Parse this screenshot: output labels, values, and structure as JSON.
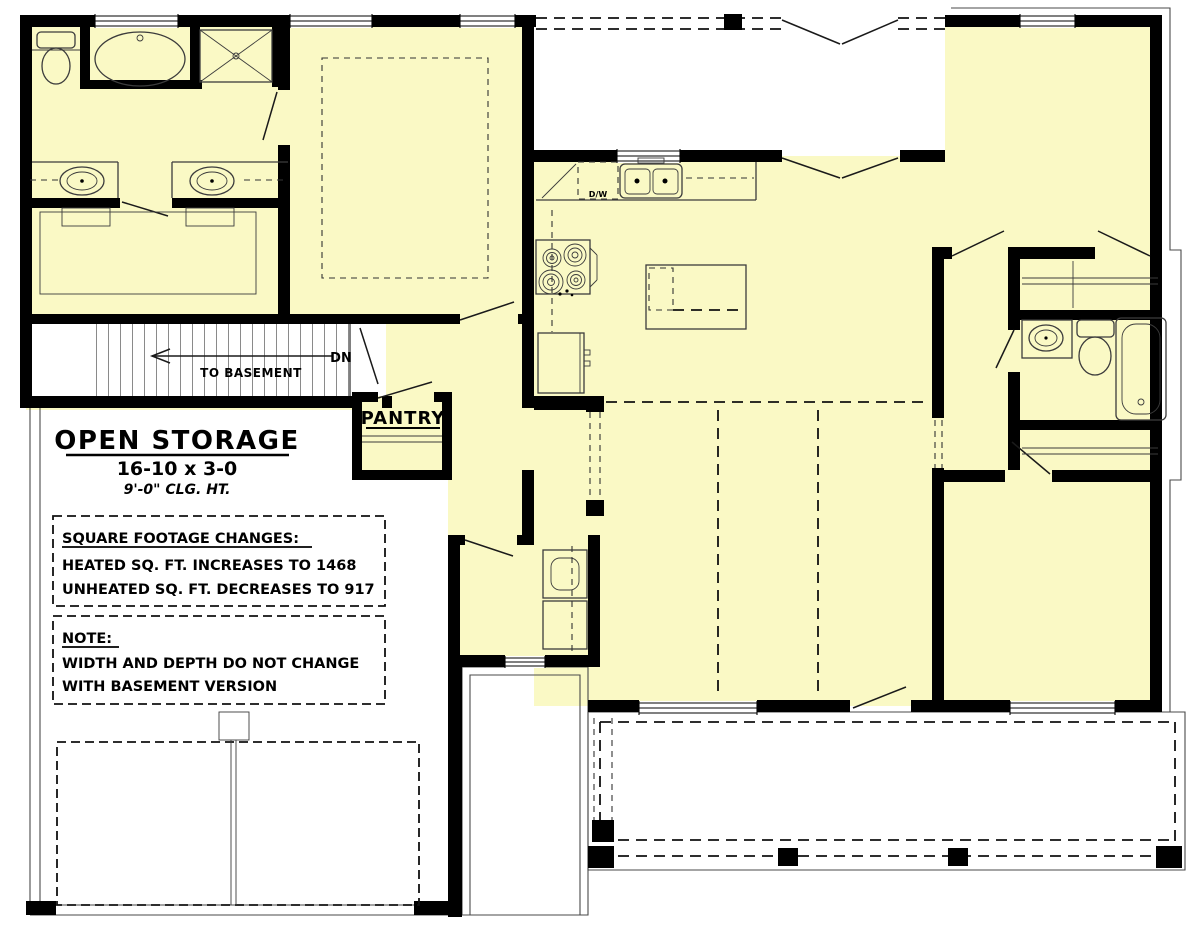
{
  "colors": {
    "room_fill": "#FAF9C5",
    "wall": "#000000",
    "line": "#3c3c3c",
    "background": "#ffffff"
  },
  "labels": {
    "open_storage": {
      "title": "OPEN STORAGE",
      "dimensions": "16-10 x 3-0",
      "ceiling": "9'-0\" CLG. HT."
    },
    "sqft_box": {
      "title": "SQUARE FOOTAGE CHANGES:",
      "line1": "HEATED SQ. FT. INCREASES TO 1468",
      "line2": "UNHEATED SQ. FT. DECREASES TO 917"
    },
    "note_box": {
      "title": "NOTE:",
      "line1": "WIDTH AND DEPTH DO NOT CHANGE",
      "line2": "WITH BASEMENT VERSION"
    },
    "stairs": {
      "direction": "DN",
      "destination": "TO BASEMENT"
    },
    "pantry": "PANTRY",
    "dishwasher": "D/W"
  }
}
